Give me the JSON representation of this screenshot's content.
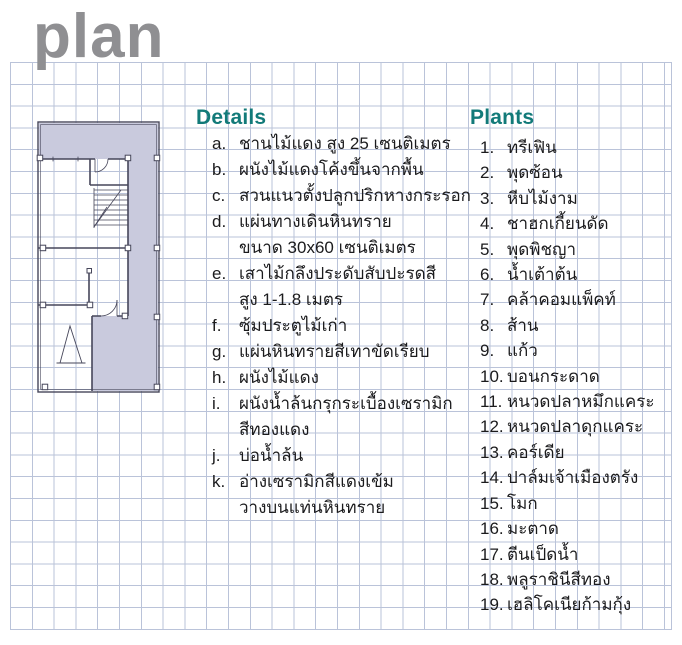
{
  "page": {
    "title": "plan"
  },
  "details": {
    "heading": "Details",
    "items": [
      {
        "label": "a.",
        "text": "ชานไม้แดง สูง 25 เซนติเมตร"
      },
      {
        "label": "b.",
        "text": "ผนังไม้แดงโค้งขึ้นจากพื้น"
      },
      {
        "label": "c.",
        "text": "สวนแนวตั้งปลูกปริกหางกระรอก"
      },
      {
        "label": "d.",
        "text": "แผ่นทางเดินหินทราย\nขนาด 30x60 เซนติเมตร"
      },
      {
        "label": "e.",
        "text": "เสาไม้กลึงประดับสับปะรดสี\nสูง 1-1.8 เมตร"
      },
      {
        "label": "f.",
        "text": "ซุ้มประตูไม้เก่า"
      },
      {
        "label": "g.",
        "text": "แผ่นหินทรายสีเทาขัดเรียบ"
      },
      {
        "label": "h.",
        "text": "ผนังไม้แดง"
      },
      {
        "label": "i.",
        "text": "ผนังน้ำล้นกรุกระเบื้องเซรามิก\nสีทองแดง"
      },
      {
        "label": "j.",
        "text": "บ่อน้ำล้น"
      },
      {
        "label": "k.",
        "text": "อ่างเซรามิกสีแดงเข้ม\nวางบนแท่นหินทราย"
      }
    ]
  },
  "plants": {
    "heading": "Plants",
    "items": [
      {
        "label": "1.",
        "text": "ทรีเฟิน"
      },
      {
        "label": "2.",
        "text": "พุดซ้อน"
      },
      {
        "label": "3.",
        "text": "หีบไม้งาม"
      },
      {
        "label": "4.",
        "text": "ชาฮกเกี้ยนดัด"
      },
      {
        "label": "5.",
        "text": "พุดพิชญา"
      },
      {
        "label": "6.",
        "text": "น้ำเต้าต้น"
      },
      {
        "label": "7.",
        "text": "คล้าคอมแพ็คท์"
      },
      {
        "label": "8.",
        "text": "ส้าน"
      },
      {
        "label": "9.",
        "text": "แก้ว"
      },
      {
        "label": "10.",
        "text": "บอนกระดาด"
      },
      {
        "label": "11.",
        "text": "หนวดปลาหมึกแคระ"
      },
      {
        "label": "12.",
        "text": "หนวดปลาดุกแคระ"
      },
      {
        "label": "13.",
        "text": "คอร์เดีย"
      },
      {
        "label": "14.",
        "text": "ปาล์มเจ้าเมืองตรัง"
      },
      {
        "label": "15.",
        "text": "โมก"
      },
      {
        "label": "16.",
        "text": "มะตาด"
      },
      {
        "label": "17.",
        "text": "ตีนเป็ดน้ำ"
      },
      {
        "label": "18.",
        "text": "พลูราชินีสีทอง"
      },
      {
        "label": "19.",
        "text": "เฮลิโคเนียก้ามกุ้ง"
      }
    ]
  },
  "colors": {
    "heading_teal": "#127a79",
    "title_gray": "#8f8f92",
    "grid_line": "#bac3d9",
    "plan_fill": "#c9cadd",
    "plan_line": "#46465a",
    "text": "#1b1b1d"
  }
}
